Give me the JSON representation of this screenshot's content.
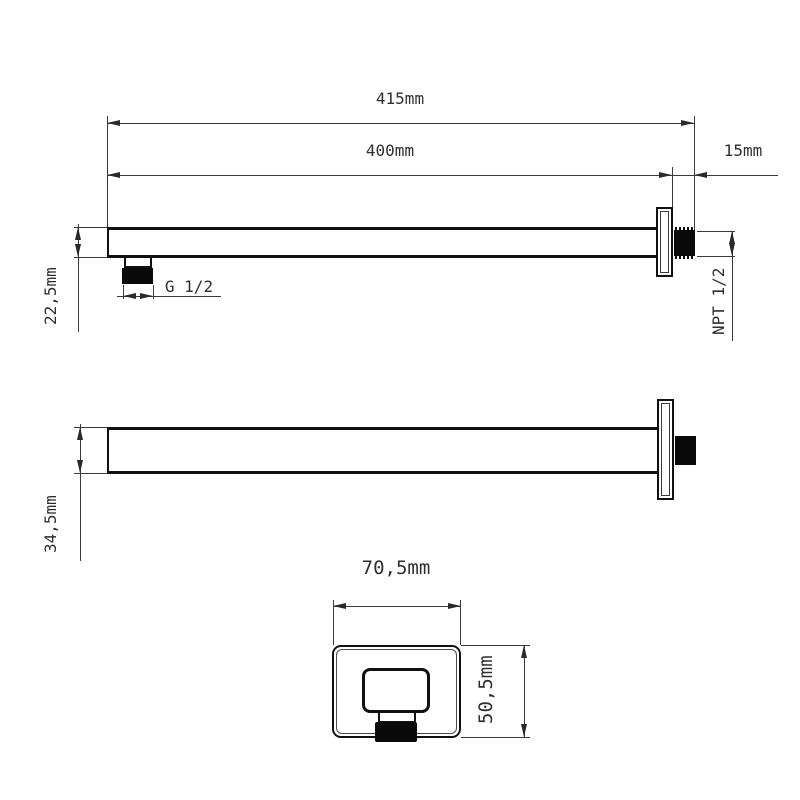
{
  "drawing": {
    "background_color": "#ffffff",
    "object_line_color": "#111111",
    "dimension_line_color": "#3a3a3a",
    "text_color": "#2f2f2f",
    "thread_fill_color": "#0a0a0a",
    "side_view": {
      "total_length": "415mm",
      "arm_length": "400mm",
      "wall_thread_length": "15mm",
      "arm_height": "22,5mm",
      "outlet_thread": "G 1/2",
      "wall_thread": "NPT 1/2"
    },
    "plan_view": {
      "arm_width": "34,5mm"
    },
    "front_view": {
      "flange_width": "70,5mm",
      "flange_height": "50,5mm"
    }
  }
}
